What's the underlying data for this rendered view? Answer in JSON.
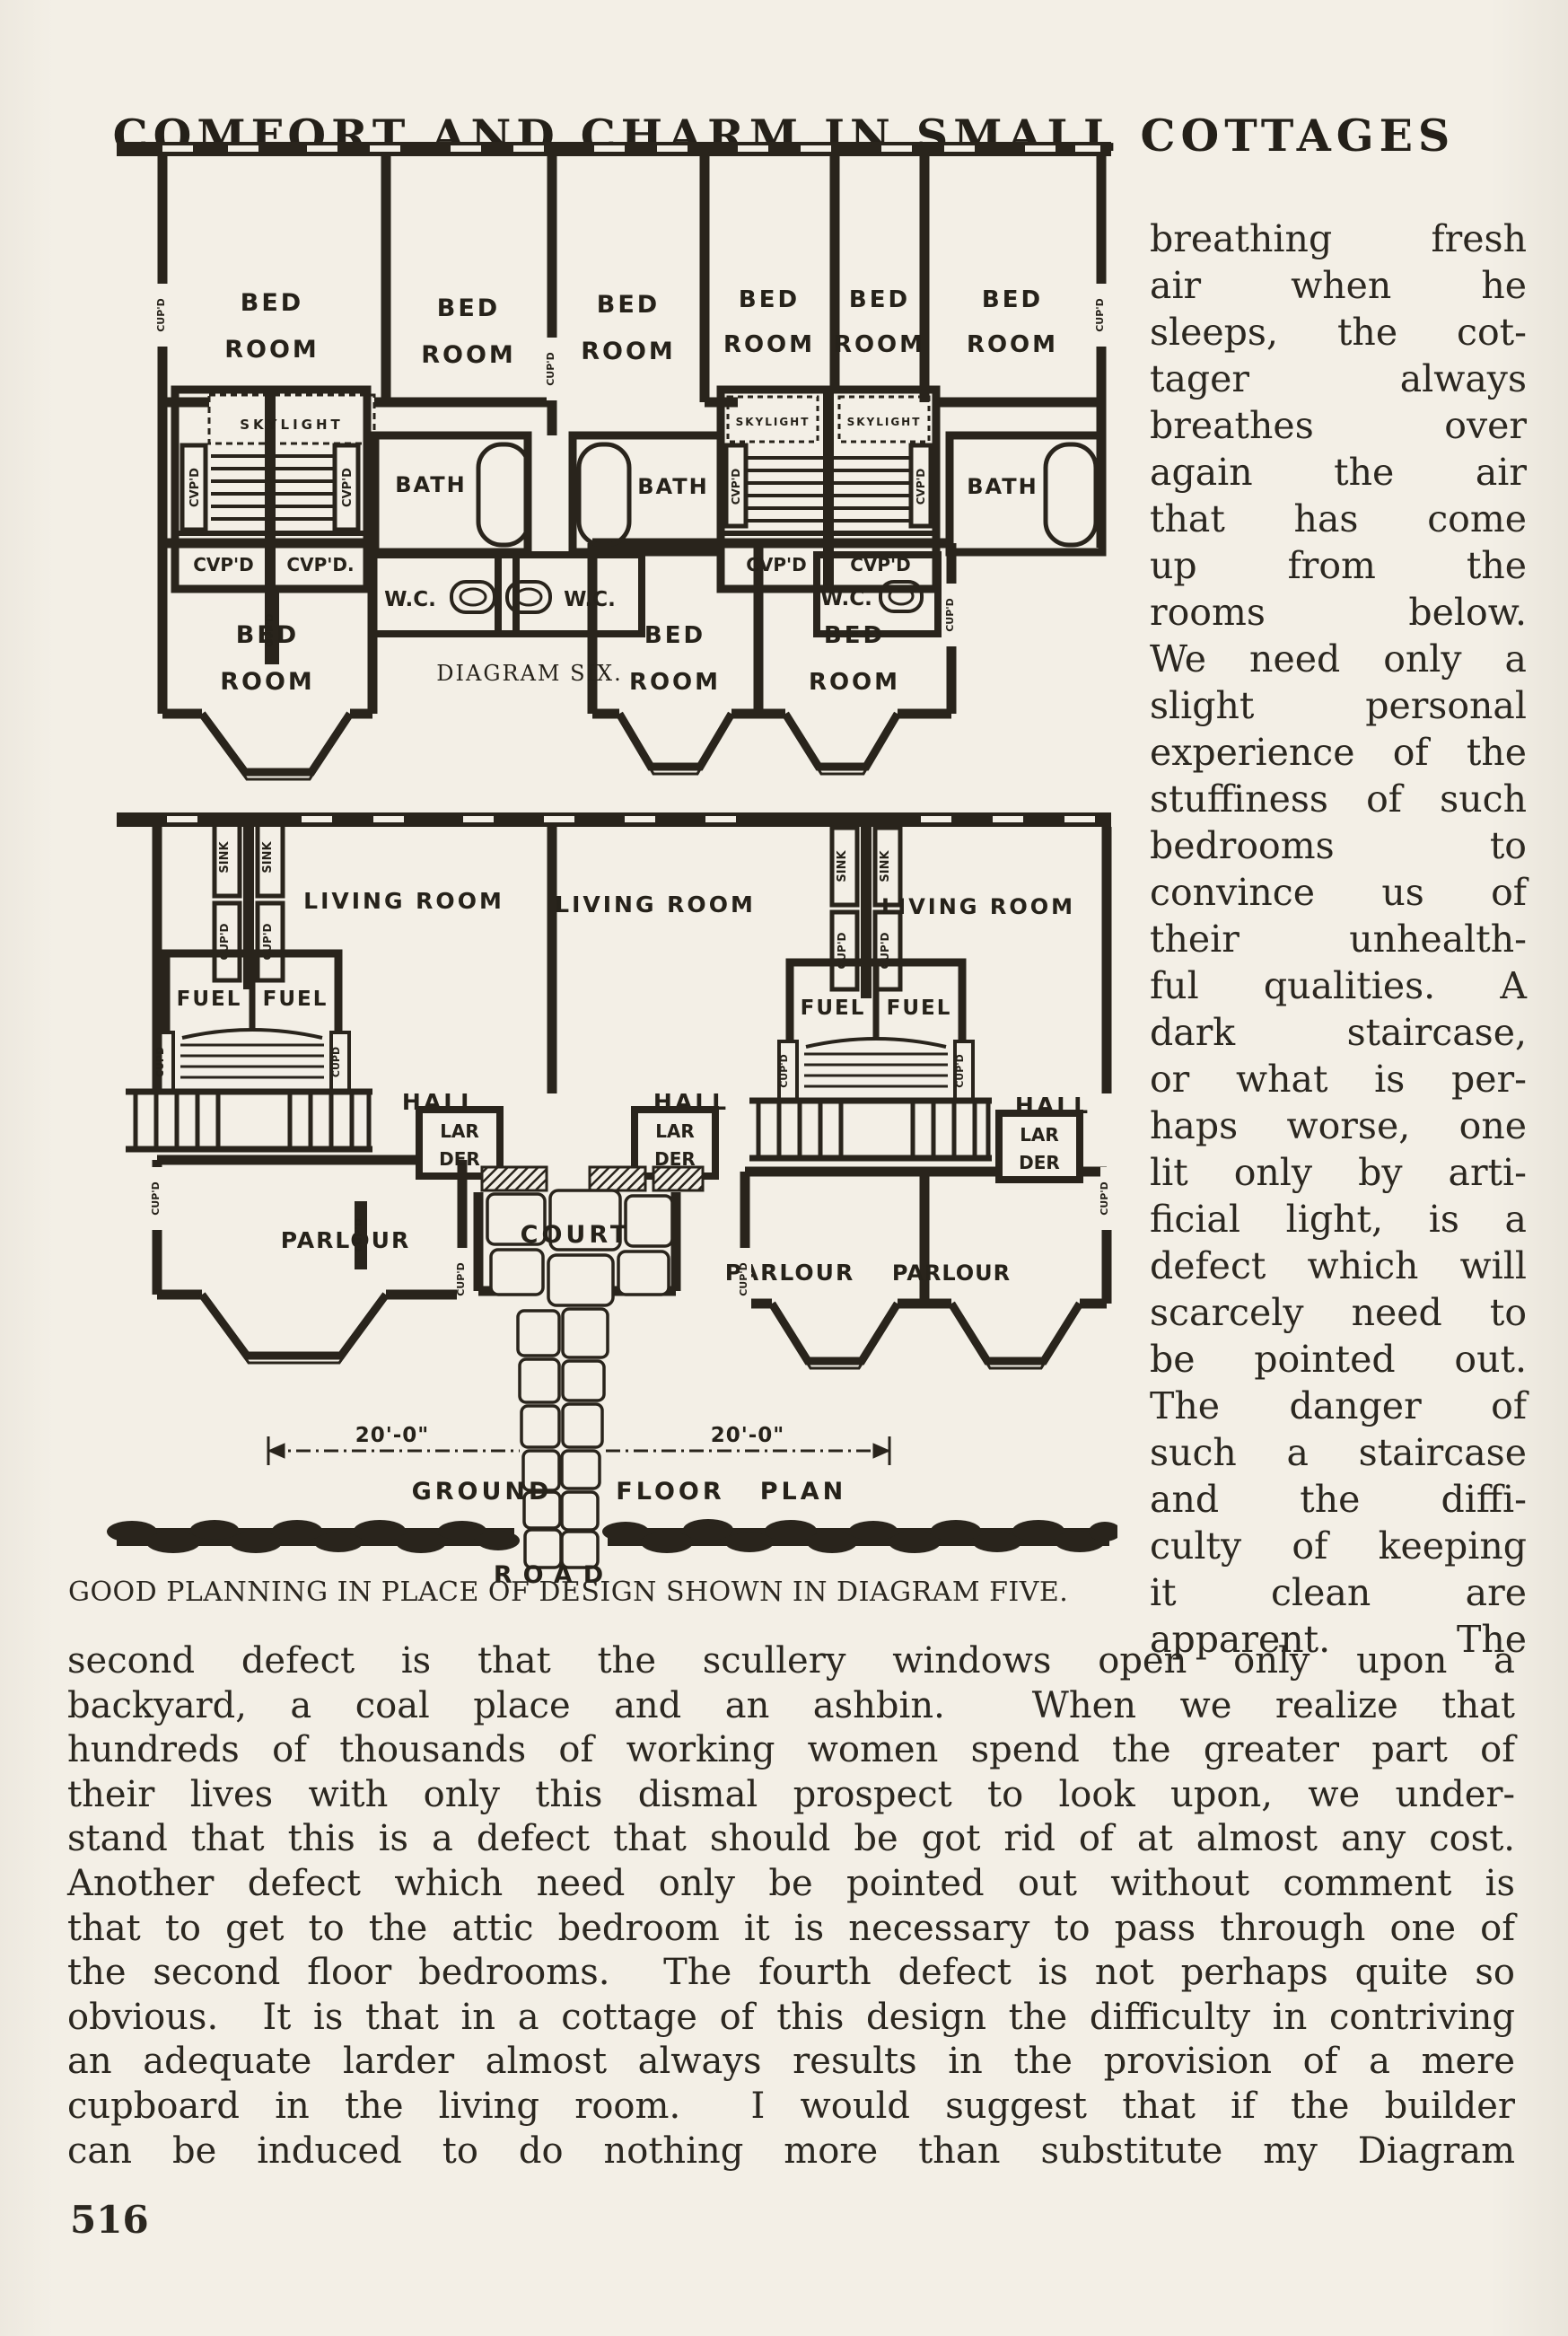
{
  "page": {
    "title": "COMFORT AND CHARM IN SMALL COTTAGES",
    "page_number": "516",
    "caption": "GOOD PLANNING IN PLACE OF DESIGN SHOWN IN DIAGRAM FIVE."
  },
  "diagram": {
    "name_label": "DIAGRAM SIX.",
    "ground_floor_title": {
      "ground": "GROUND",
      "floor": "FLOOR",
      "plan": "PLAN"
    },
    "road": "ROAD",
    "dimension_left": "20'-0\"",
    "dimension_right": "20'-0\"",
    "plan_labels": {
      "bed": "BED",
      "room": "ROOM",
      "bath": "BATH",
      "wc": "W.C.",
      "skylight": "SKYLIGHT",
      "cupd": "CUP'D",
      "cupd_dot": "CUP'D.",
      "cvpd": "CVP'D",
      "cvpd_dot": "CVP'D.",
      "cupd_short": "CUPD",
      "sink": "SINK",
      "living_room": "LIVING ROOM",
      "fuel": "FUEL",
      "hall": "HALL",
      "lar": "LAR",
      "der": "DER",
      "parlour": "PARLOUR",
      "court": "COURT"
    }
  },
  "right_column": {
    "lines": [
      "breathing fresh",
      "air when he",
      "sleeps, the cot-",
      "tager always",
      "breathes over",
      "again the air",
      "that has come",
      "up from the",
      "rooms below.",
      "We need only a",
      "slight personal",
      "experience of the",
      "stuffiness of such",
      "bedrooms to",
      "convince us of",
      "their unhealth-",
      "ful qualities. A",
      "dark staircase,",
      "or what is per-",
      "haps worse, one",
      "lit only by arti-",
      "ficial light, is a",
      "defect which will",
      "scarcely need to",
      "be pointed out.",
      "The danger of",
      "such a staircase",
      "and the diffi-",
      "culty of keeping",
      "it clean are",
      "apparent.  The"
    ]
  },
  "body": {
    "lines": [
      "second defect is that the scullery windows open only upon a",
      "backyard, a coal place and an ashbin.  When we realize that",
      "hundreds of thousands of working women spend the greater part of",
      "their lives with only this dismal prospect to look upon, we under-",
      "stand that this is a defect that should be got rid of at almost any cost.",
      "Another defect which need only be pointed out without comment is",
      "that to get to the attic bedroom it is necessary to pass through one of",
      "the second floor bedrooms.  The fourth defect is not perhaps quite so",
      "obvious.  It is that in a cottage of this design the difficulty in contriving",
      "an adequate larder almost always results in the provision of a mere",
      "cupboard in the living room.  I would suggest that if the builder",
      "can be induced to do nothing more than substitute my Diagram"
    ]
  }
}
